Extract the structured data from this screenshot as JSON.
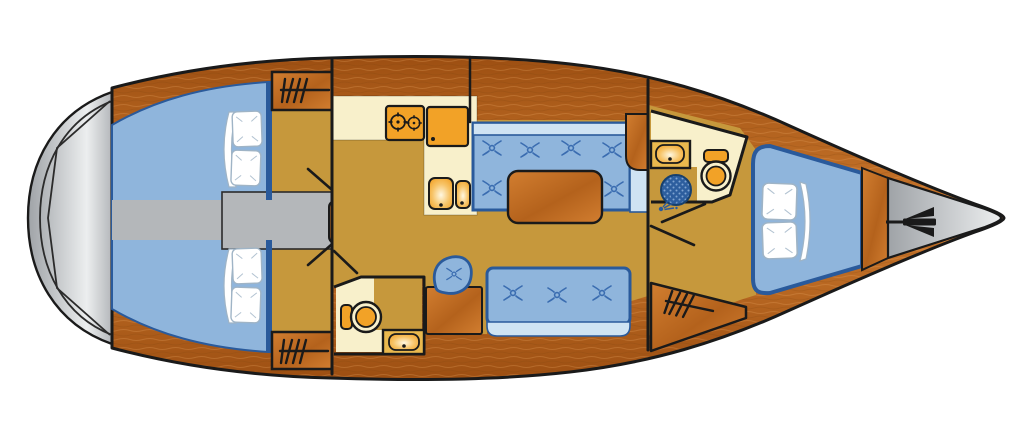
{
  "diagram": {
    "type": "yacht-floor-plan",
    "title": "Sailing yacht interior deck plan (top view, bow to the right)",
    "orientation": {
      "bow": "right",
      "stern": "left",
      "port": "top",
      "starboard": "bottom"
    },
    "rooms": [
      {
        "id": "swim-platform",
        "name": "Stern swim platform"
      },
      {
        "id": "aft-cabin-port",
        "name": "Aft double cabin, port side",
        "features": [
          "double-berth",
          "two-pillows",
          "hanging-locker"
        ]
      },
      {
        "id": "aft-cabin-starboard",
        "name": "Aft double cabin, starboard side",
        "features": [
          "double-berth",
          "two-pillows",
          "hanging-locker"
        ]
      },
      {
        "id": "companionway",
        "name": "Companionway",
        "features": [
          "steps",
          "engine-compartment"
        ]
      },
      {
        "id": "galley",
        "name": "L-shaped galley",
        "features": [
          "two-burner-stove",
          "refrigerator",
          "double-sink"
        ]
      },
      {
        "id": "salon",
        "name": "Salon",
        "features": [
          "port-settee",
          "saloon-table",
          "starboard-settee"
        ]
      },
      {
        "id": "nav-station",
        "name": "Navigation station",
        "features": [
          "chart-table",
          "swivel-seat"
        ]
      },
      {
        "id": "aft-head",
        "name": "Aft head",
        "features": [
          "toilet",
          "washbasin"
        ]
      },
      {
        "id": "forward-head",
        "name": "Forward head",
        "features": [
          "washbasin",
          "toilet",
          "shower"
        ]
      },
      {
        "id": "forward-cabin",
        "name": "Forward V-berth cabin",
        "features": [
          "v-berth",
          "two-pillows",
          "hanging-locker"
        ]
      },
      {
        "id": "anchor-locker",
        "name": "Bow anchor locker",
        "features": [
          "anchor"
        ]
      }
    ],
    "palette": {
      "line": "#1a1a1a",
      "hull_wood": "#b96524",
      "hull_wood_dark": "#9d4f12",
      "hull_wood_light": "#cd7a2e",
      "furn_wood": "#b4621c",
      "furn_wood_light": "#d27e30",
      "tan_floor": "#c6983c",
      "cream": "#f8f0cb",
      "gold": "#eab94e",
      "orange": "#f2a227",
      "blue_cushion": "#8fb5dc",
      "blue_light": "#cfe3f3",
      "blue_dark": "#2a5a9b",
      "button_blue": "#3a6cb0",
      "shower_blue": "#2d5e9e",
      "shower_dot": "#7fa4d2",
      "gray_deck": "#b4b7ba",
      "gray_mid": "#9fa3a7",
      "gray_light": "#eceeef",
      "pillow_line": "#9fb4c6",
      "white": "#ffffff"
    }
  }
}
